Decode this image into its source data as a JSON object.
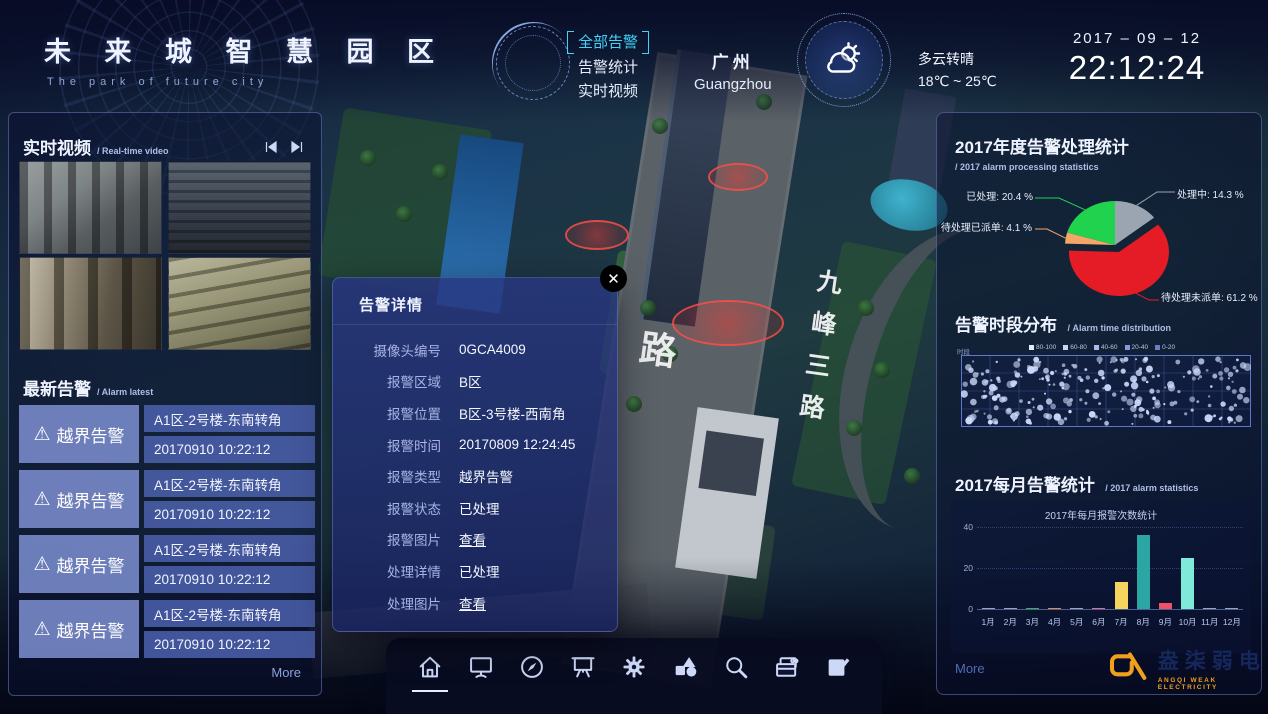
{
  "header": {
    "title": "未 来 城 智 慧 园 区",
    "subtitle": "The park of future city",
    "nav": [
      {
        "label": "全部告警",
        "active": true
      },
      {
        "label": "告警统计",
        "active": false
      },
      {
        "label": "实时视频",
        "active": false
      }
    ],
    "city_cn": "广州",
    "city_en": "Guangzhou",
    "weather_condition": "多云转晴",
    "weather_temp": "18℃ ~ 25℃",
    "date": "2017 – 09 – 12",
    "time": "22:12:24"
  },
  "left_panel": {
    "video_title": "实时视频",
    "video_subtitle": "/ Real-time video",
    "alarm_title": "最新告警",
    "alarm_subtitle": "/ Alarm latest",
    "alarms": [
      {
        "type": "越界告警",
        "location": "A1区-2号楼-东南转角",
        "time": "20170910 10:22:12"
      },
      {
        "type": "越界告警",
        "location": "A1区-2号楼-东南转角",
        "time": "20170910 10:22:12"
      },
      {
        "type": "越界告警",
        "location": "A1区-2号楼-东南转角",
        "time": "20170910 10:22:12"
      },
      {
        "type": "越界告警",
        "location": "A1区-2号楼-东南转角",
        "time": "20170910 10:22:12"
      }
    ],
    "more_label": "More"
  },
  "modal": {
    "title": "告警详情",
    "fields": [
      {
        "label": "摄像头编号",
        "value": "0GCA4009",
        "link": false
      },
      {
        "label": "报警区域",
        "value": "B区",
        "link": false
      },
      {
        "label": "报警位置",
        "value": "B区-3号楼-西南角",
        "link": false
      },
      {
        "label": "报警时间",
        "value": "20170809 12:24:45",
        "link": false
      },
      {
        "label": "报警类型",
        "value": "越界告警",
        "link": false
      },
      {
        "label": "报警状态",
        "value": "已处理",
        "link": false
      },
      {
        "label": "报警图片",
        "value": "查看",
        "link": true
      },
      {
        "label": "处理详情",
        "value": "已处理",
        "link": false
      },
      {
        "label": "处理图片",
        "value": "查看",
        "link": true
      }
    ]
  },
  "map": {
    "road_label_vertical": "九峰三路",
    "road_label_left": "路"
  },
  "right_panel": {
    "more_label": "More"
  },
  "chart_data": [
    {
      "type": "pie",
      "title": "2017年度告警处理统计",
      "subtitle": "/ 2017 alarm processing statistics",
      "series": [
        {
          "name": "处理中",
          "value": 14.3,
          "color": "#9aa5b1",
          "label": "处理中: 14.3 %",
          "offset": false
        },
        {
          "name": "待处理未派单",
          "value": 61.2,
          "color": "#e51c25",
          "label": "待处理未派单: 61.2 %",
          "offset": true
        },
        {
          "name": "待处理已派单",
          "value": 4.1,
          "color": "#f2a668",
          "label": "待处理已派单: 4.1 %",
          "offset": false
        },
        {
          "name": "已处理",
          "value": 20.4,
          "color": "#21d24f",
          "label": "已处理: 20.4 %",
          "offset": false
        }
      ]
    },
    {
      "type": "scatter",
      "title": "告警时段分布",
      "subtitle": "/ Alarm time distribution",
      "axis_label": "时段",
      "legend": [
        "80-100",
        "60-80",
        "40-60",
        "20-40",
        "0-20"
      ],
      "legend_colors": [
        "#e3eafc",
        "#c7d4f7",
        "#a7b9ee",
        "#8799dd",
        "#6b7dc4"
      ],
      "point_color": "#ccd9fb",
      "point_count": 235,
      "x_range": "0-24h",
      "grid": {
        "cols": 10,
        "rows": 4
      }
    },
    {
      "type": "bar",
      "title": "2017每月告警统计",
      "subtitle": "/ 2017 alarm statistics",
      "inner_title": "2017年每月报警次数统计",
      "categories": [
        "1月",
        "2月",
        "3月",
        "4月",
        "5月",
        "6月",
        "7月",
        "8月",
        "9月",
        "10月",
        "11月",
        "12月"
      ],
      "values": [
        0.5,
        0.5,
        0.7,
        0.7,
        0.5,
        0.7,
        13,
        36,
        3,
        25,
        0.4,
        0.2
      ],
      "colors": [
        "#9aa5b1",
        "#9aa5b1",
        "#35b05a",
        "#e08a4a",
        "#9aa5b1",
        "#e06a9a",
        "#f5d55e",
        "#2ca6a4",
        "#f14f68",
        "#7fe9da",
        "#9aa5b1",
        "#9aa5b1"
      ],
      "ylim": [
        0,
        40
      ],
      "yticks": [
        40,
        20,
        0
      ]
    }
  ],
  "toolbar": {
    "icons": [
      "home",
      "monitor",
      "compass",
      "projection-screen",
      "gear",
      "shapes",
      "search",
      "wallet",
      "edit"
    ],
    "active_icon": "home"
  },
  "icons": {
    "close": "✕",
    "warning": "⚠"
  },
  "footer": {
    "logo_cn": "盎柒弱电",
    "logo_en": "ANGQI WEAK ELECTRICITY"
  }
}
